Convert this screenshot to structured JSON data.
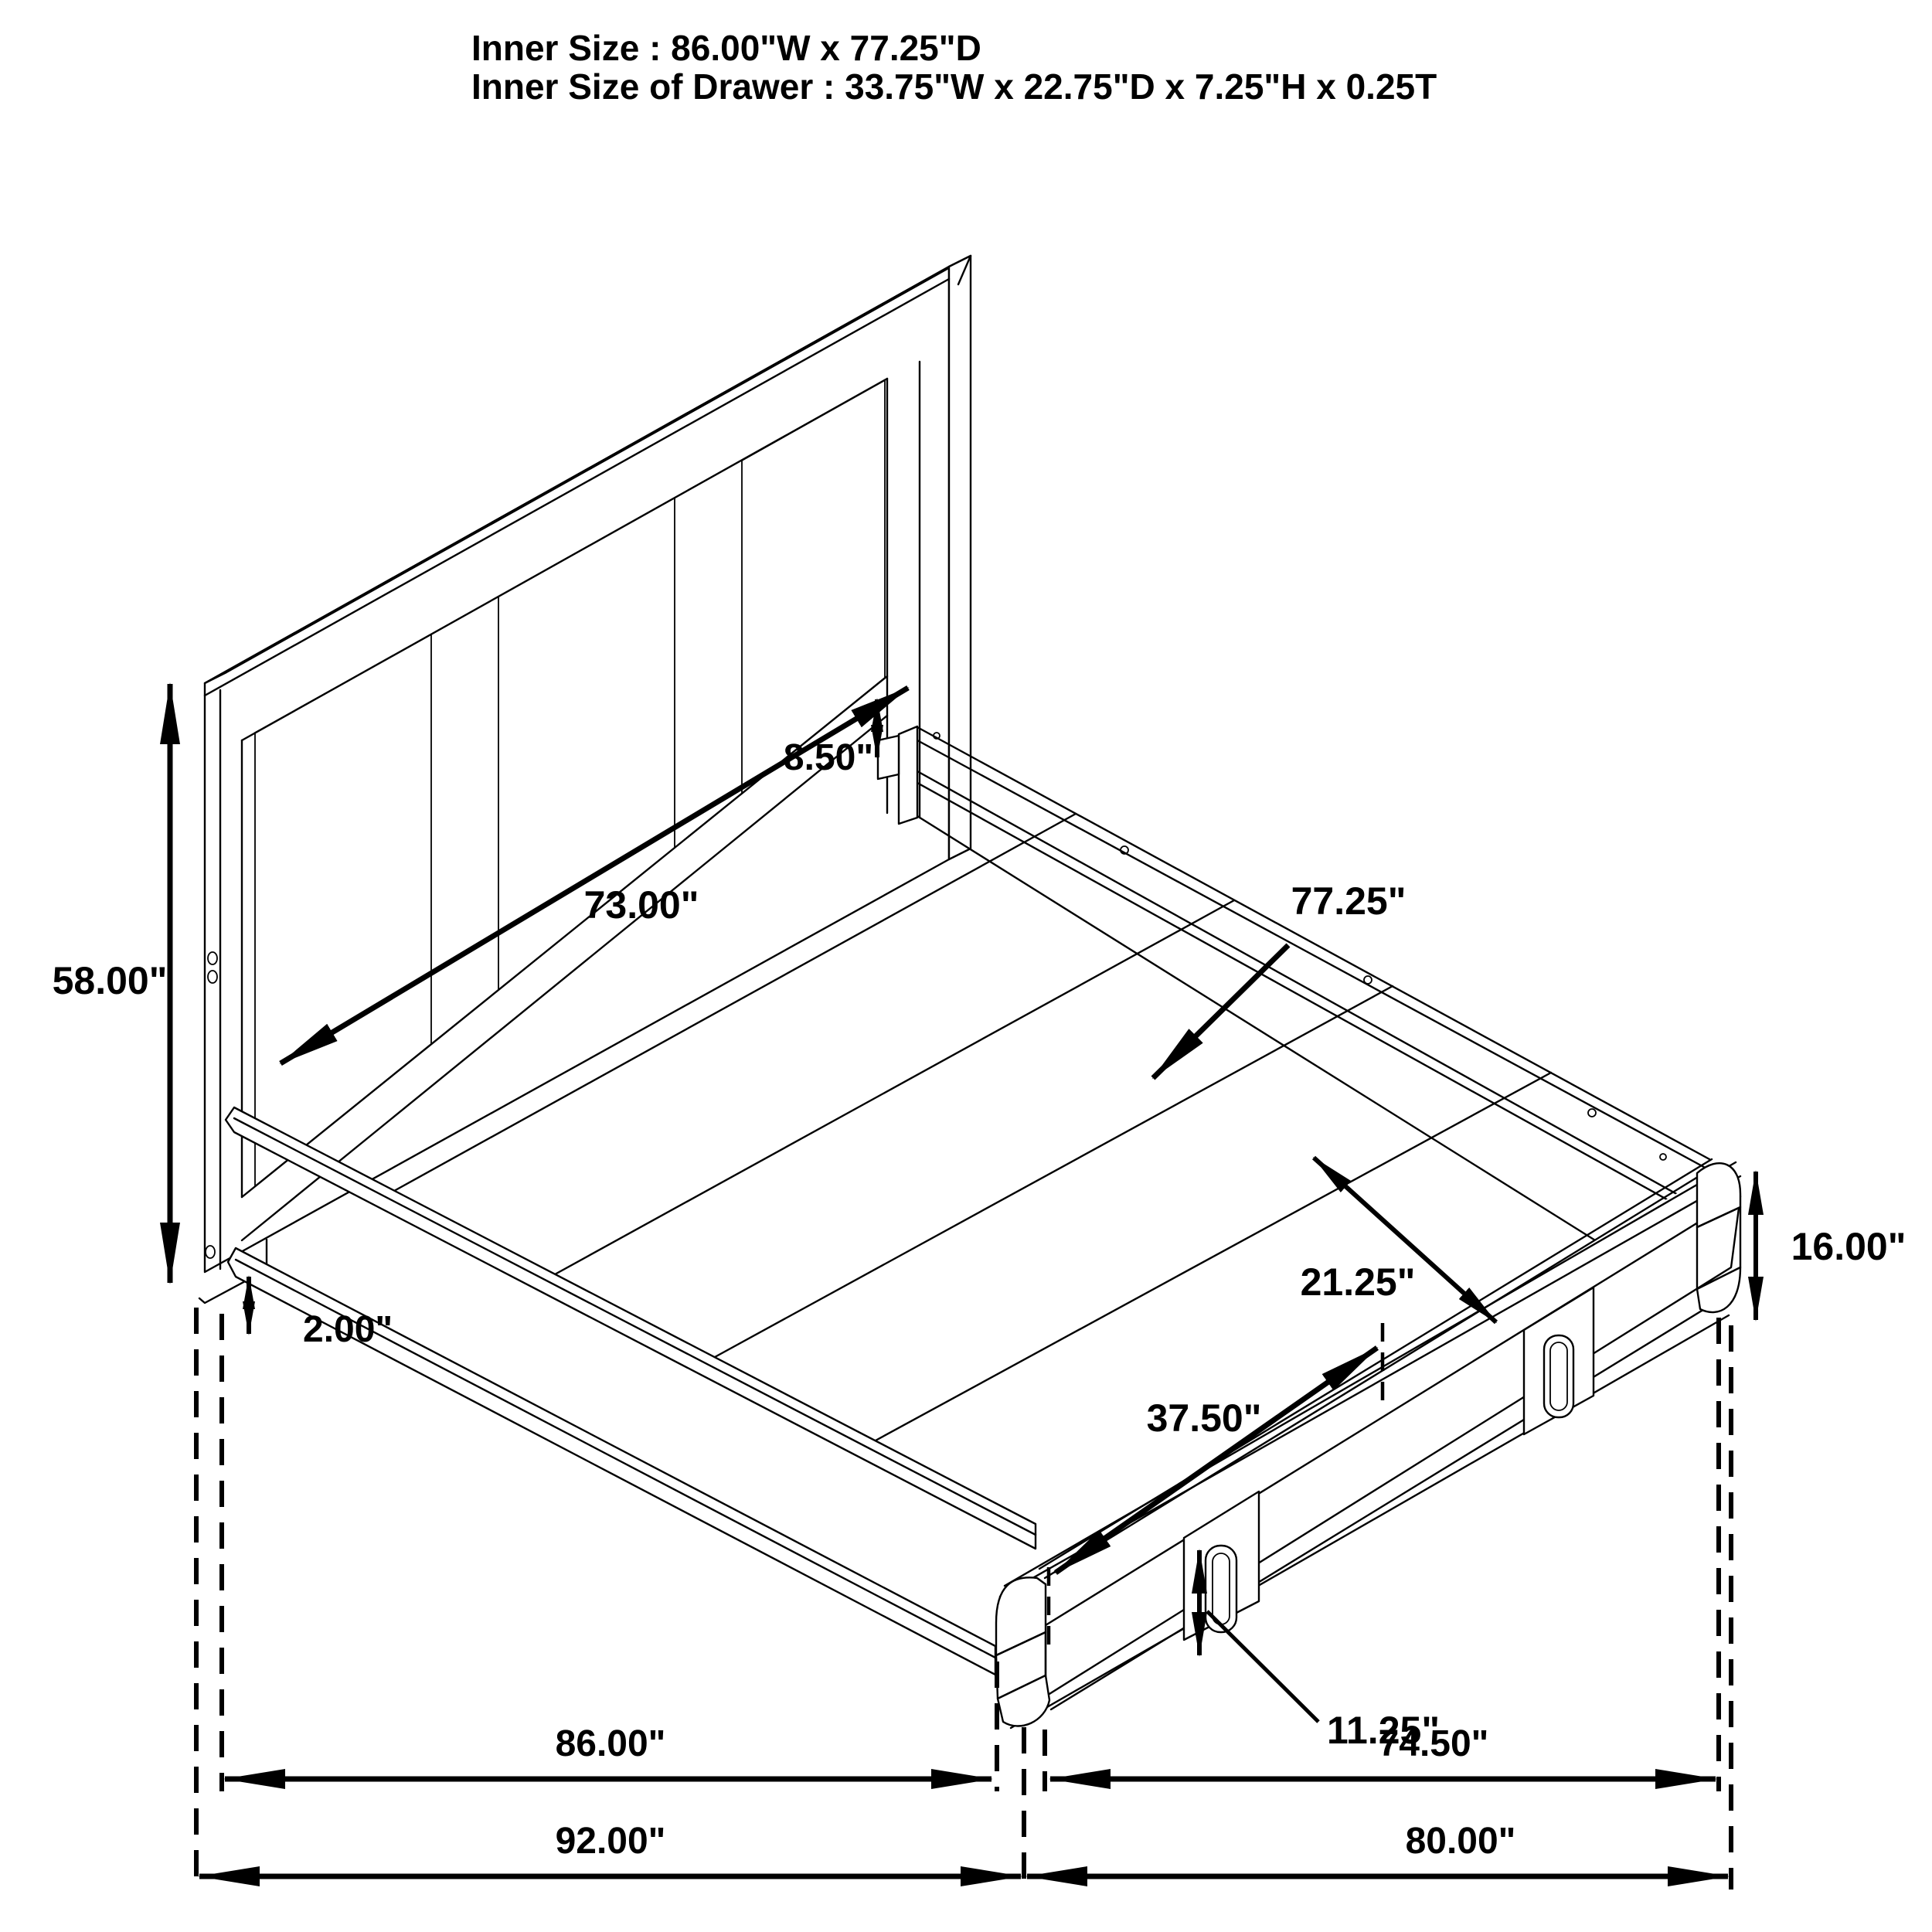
{
  "title": {
    "line1": "Inner Size : 86.00\"W x 77.25\"D",
    "line2": "Inner Size of Drawer : 33.75\"W x 22.75\"D x 7.25\"H x 0.25T"
  },
  "labels": {
    "headboard_height": "58.00\"",
    "headboard_inner_width": "73.00\"",
    "headboard_rail_gap": "8.50\"",
    "platform_depth": "77.25\"",
    "rail_segment": "21.25\"",
    "footboard_height": "16.00\"",
    "drawer_width": "37.50\"",
    "drawer_front_height": "11.25\"",
    "base_clearance": "2.00\"",
    "base_width_inner": "86.00\"",
    "base_depth_inner": "74.50\"",
    "overall_width": "92.00\"",
    "overall_depth": "80.00\""
  },
  "colors": {
    "line": "#000000",
    "background": "#ffffff"
  }
}
